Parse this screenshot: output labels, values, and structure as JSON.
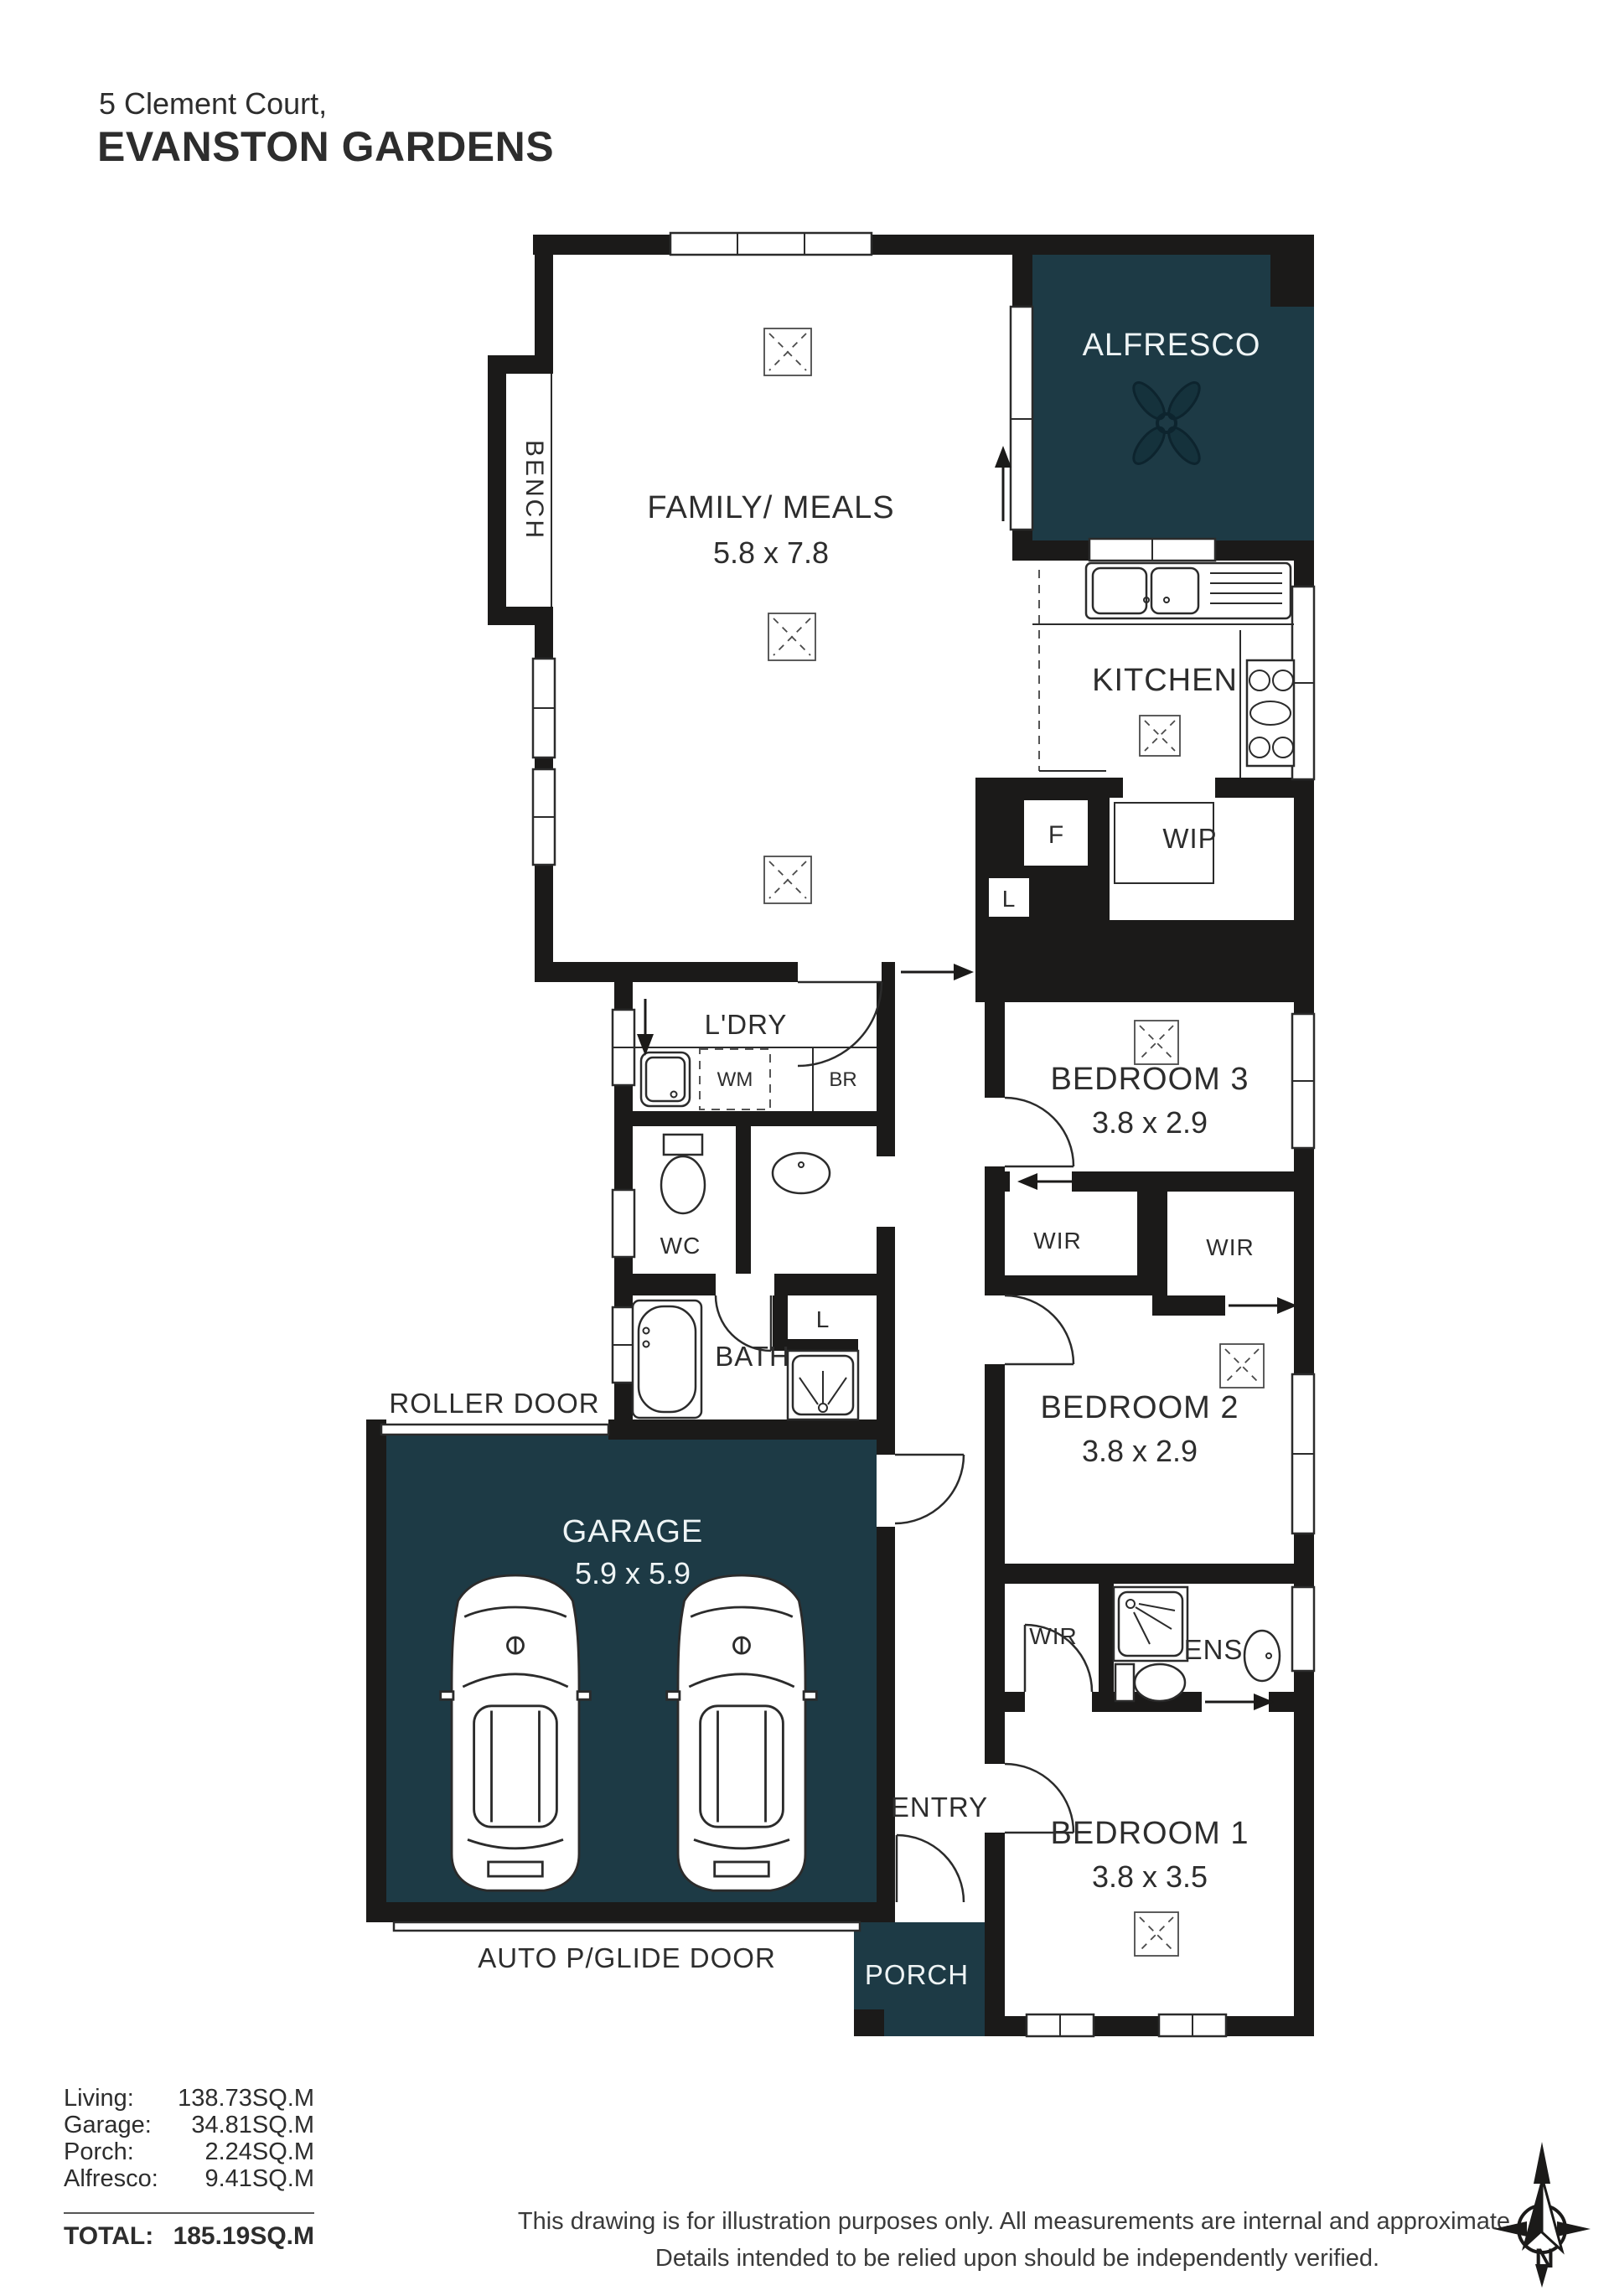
{
  "header": {
    "title_line1": "5 Clement Court,",
    "title_line2": "EVANSTON GARDENS"
  },
  "rooms": {
    "bench": "BENCH",
    "family": "FAMILY/ MEALS",
    "family_dims": "5.8 x 7.8",
    "alfresco": "ALFRESCO",
    "kitchen": "KITCHEN",
    "fridge": "F",
    "linen_kitchen": "L",
    "wip": "WIP",
    "laundry": "L'DRY",
    "wm": "WM",
    "br": "BR",
    "wc": "WC",
    "bath": "BATH",
    "linen_bath": "L",
    "bed3": "BEDROOM 3",
    "bed3_dims": "3.8 x 2.9",
    "wir_bed3": "WIR",
    "wir_bed2": "WIR",
    "bed2": "BEDROOM 2",
    "bed2_dims": "3.8 x 2.9",
    "garage": "GARAGE",
    "garage_dims": "5.9 x 5.9",
    "roller_door": "ROLLER DOOR",
    "auto_door": "AUTO P/GLIDE DOOR",
    "wir_bed1": "WIR",
    "ens": "ENS",
    "entry": "ENTRY",
    "porch": "PORCH",
    "bed1": "BEDROOM 1",
    "bed1_dims": "3.8 x 3.5"
  },
  "areas": {
    "rows": [
      {
        "label": "Living:",
        "value": "138.73SQ.M"
      },
      {
        "label": "Garage:",
        "value": "34.81SQ.M"
      },
      {
        "label": "Porch:",
        "value": "2.24SQ.M"
      },
      {
        "label": "Alfresco:",
        "value": "9.41SQ.M"
      }
    ],
    "total_label": "TOTAL:",
    "total_value": "185.19SQ.M"
  },
  "disclaimer": {
    "line1": "This drawing is for illustration purposes only. All measurements are internal and approximate.",
    "line2": "Details intended to be relied upon should be independently verified."
  },
  "compass": {
    "label": "N"
  },
  "colors": {
    "accent_teal": "#1d3a45",
    "wall_black": "#1b1a19"
  }
}
